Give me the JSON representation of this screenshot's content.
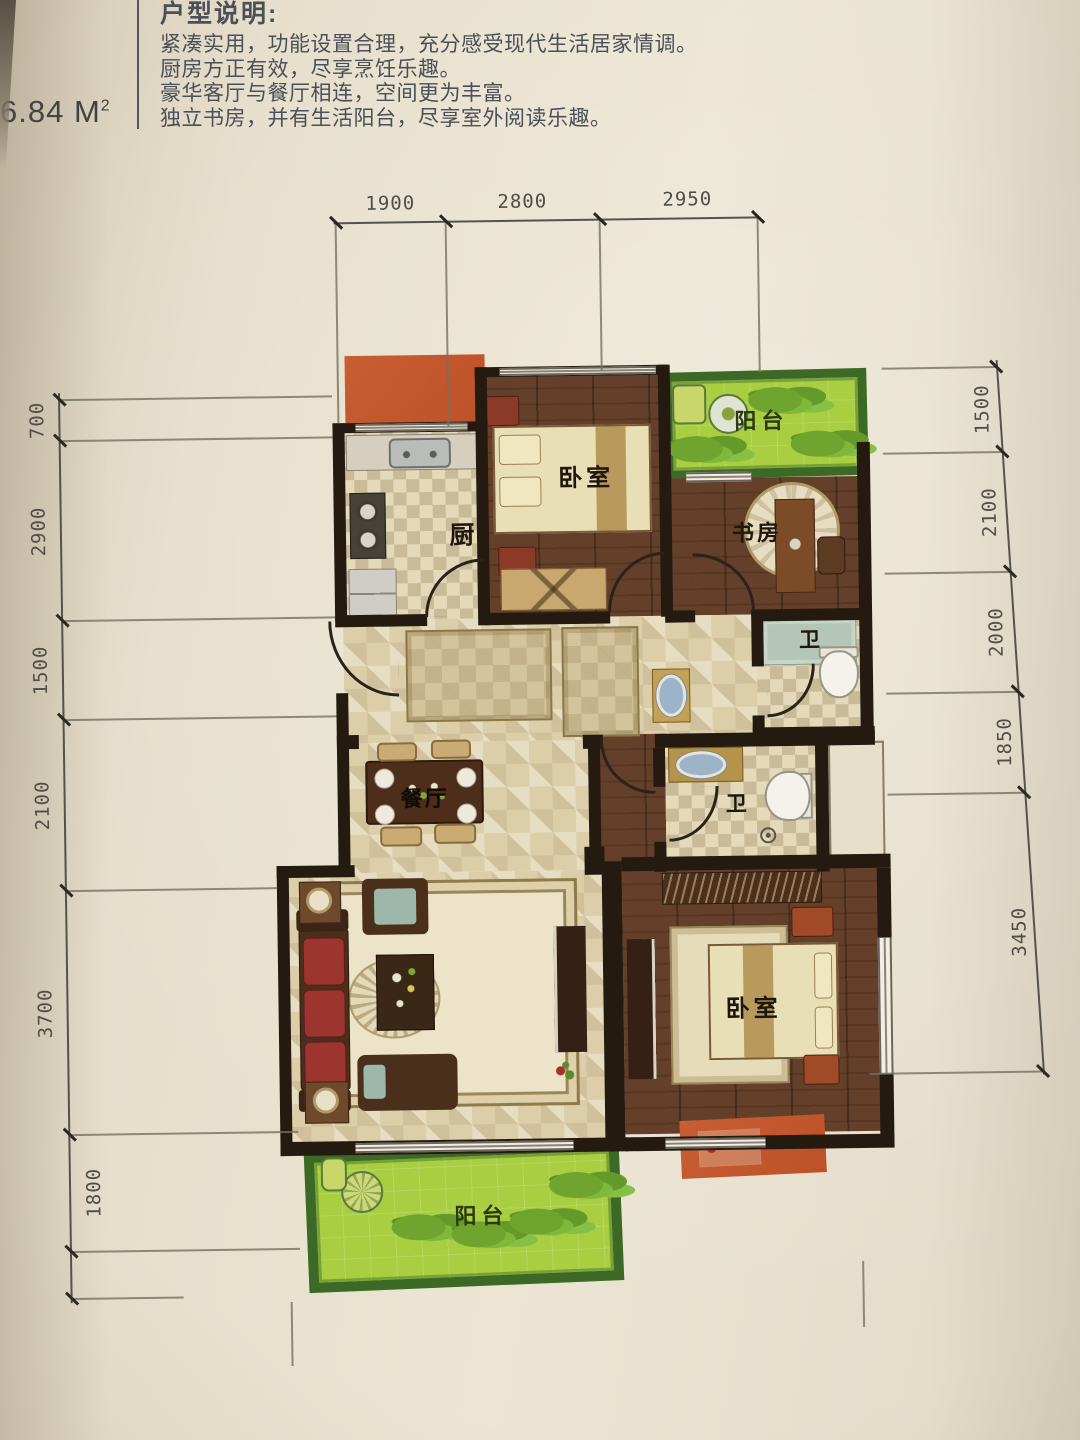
{
  "header": {
    "area_value": "6.84",
    "area_unit": " M",
    "area_sup": "2",
    "title": "户型说明:",
    "desc_lines": [
      "紧凑实用，功能设置合理，充分感受现代生活居家情调。",
      "厨房方正有效，尽享烹饪乐趣。",
      "豪华客厅与餐厅相连，空间更为丰富。",
      "独立书房，并有生活阳台，尽享室外阅读乐趣。"
    ]
  },
  "plan": {
    "room_labels": {
      "kitchen": "厨",
      "bedroom_top": "卧室",
      "balcony_top": "阳台",
      "study": "书房",
      "bath_top": "卫",
      "dining": "餐厅",
      "bath_bottom": "卫",
      "bedroom_bottom": "卧室",
      "balcony_bottom": "阳台"
    },
    "dims_top": [
      "1900",
      "2800",
      "2950"
    ],
    "dims_left": [
      "700",
      "2900",
      "1500",
      "2100",
      "3700",
      "1800"
    ],
    "dims_right": [
      "1500",
      "2100",
      "2000",
      "1850",
      "3450"
    ]
  },
  "colors": {
    "paper": "#e9e1cf",
    "wall": "#241a10",
    "wood_floor": "#5e3b26",
    "tile": "#dbcea9",
    "balcony_green": "#a9ce42",
    "balcony_frame": "#3c6a26",
    "accent_orange": "#c85e33",
    "bath_mat_teal": "#b4c6b7",
    "sofa_red": "#9c3430",
    "dim_text": "#504d47"
  }
}
